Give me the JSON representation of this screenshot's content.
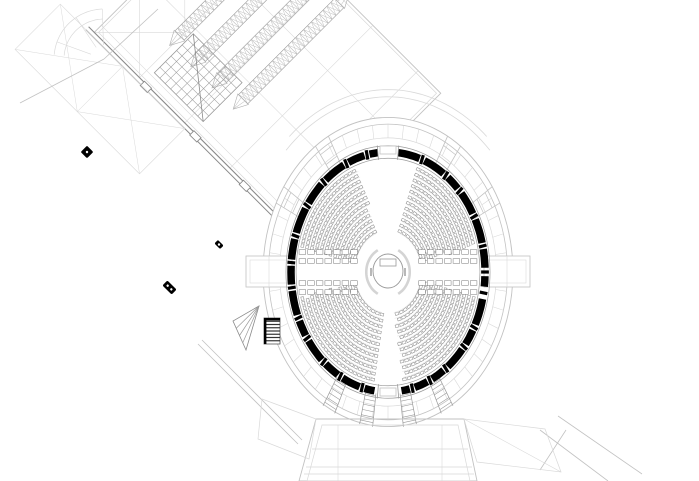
{
  "meta": {
    "drawing_type": "architectural-floor-plan",
    "subject": "elliptical auditorium with two angled wings",
    "canvas": {
      "width": 699,
      "height": 481
    }
  },
  "colors": {
    "background": "#ffffff",
    "faint": "#d9d9d9",
    "light": "#c2c2c2",
    "mid": "#9a9a9a",
    "dark": "#666666",
    "black": "#000000",
    "seat": "#8f8f8f",
    "guide": "#e3e3e3"
  },
  "auditorium": {
    "center": {
      "x": 388,
      "y": 272
    },
    "base": {
      "rx": 97,
      "ry": 120
    },
    "outer_rings": [
      {
        "f": 1.288,
        "stroke": "light",
        "w": 0.9
      },
      {
        "f": 1.232,
        "stroke": "light",
        "w": 0.8
      },
      {
        "f": 1.118,
        "stroke": "faint",
        "w": 0.7
      }
    ],
    "shoulder_arcs": [
      {
        "f": 1.52,
        "a0": -132,
        "a1": -48
      },
      {
        "f": 1.46,
        "a0": -136,
        "a1": -44
      }
    ],
    "tick": {
      "step": 7.5,
      "f0": 1.118,
      "f1": 1.232
    },
    "wall": {
      "thickness": 7.5,
      "face_in_f": 0.948,
      "face_out_f": 1.052,
      "segments": [
        [
          -84,
          -71
        ],
        [
          -68,
          -55
        ],
        [
          -52,
          -44
        ],
        [
          -41,
          -29
        ],
        [
          -26,
          -14
        ],
        [
          -11,
          -2
        ],
        [
          2,
          7
        ],
        [
          13,
          26
        ],
        [
          29,
          37
        ],
        [
          40,
          52
        ],
        [
          55,
          63
        ],
        [
          66,
          74
        ],
        [
          77,
          82
        ],
        [
          98,
          104
        ],
        [
          107,
          118
        ],
        [
          121,
          130
        ],
        [
          133,
          145
        ],
        [
          148,
          156
        ],
        [
          159,
          171
        ],
        [
          174,
          183
        ],
        [
          186,
          196
        ],
        [
          199,
          212
        ],
        [
          215,
          227
        ],
        [
          230,
          243
        ],
        [
          246,
          256
        ],
        [
          259,
          264
        ]
      ],
      "tick_f0": 0.96,
      "tick_f1": 1.04,
      "door_angles": [
        -90,
        90
      ],
      "door_jamb_offset": 6,
      "door_rects": [
        {
          "x": 380,
          "y": 146,
          "w": 16,
          "h": 8
        },
        {
          "x": 380,
          "y": 388,
          "w": 16,
          "h": 8
        }
      ]
    },
    "spokes_wedge": {
      "angles": [
        -150,
        -122,
        -58,
        -30
      ],
      "half_deg": 3.5,
      "f0": 1.0,
      "f1": 1.29,
      "cross_f": [
        1.1,
        1.2
      ]
    },
    "spokes_stair": {
      "angles": [
        62,
        80,
        100,
        118
      ],
      "half_deg": 3,
      "f0": 1.02,
      "f1": 1.3,
      "rung_step_f": 0.045
    },
    "connectors": [
      {
        "x": 246,
        "y": 256,
        "w": 46,
        "h": 31
      },
      {
        "x": 484,
        "y": 256,
        "w": 46,
        "h": 31
      }
    ],
    "seating": {
      "rows": 12,
      "f_inner": 0.36,
      "f_step": 0.05,
      "seat": {
        "w": 3.5,
        "h": 2.6,
        "spacing": 4.7
      },
      "sectors": [
        [
          -70,
          -14
        ],
        [
          14,
          80
        ],
        [
          100,
          166
        ],
        [
          194,
          250
        ]
      ],
      "guide_inset": 0.018
    },
    "desks": {
      "dy": [
        -20,
        -11,
        11,
        20
      ],
      "x0": 34,
      "x1": 94,
      "pitch": 8.6,
      "w": 6.6,
      "h": 4.6
    },
    "podium": {
      "rx": 15,
      "ry": 17,
      "rect": {
        "x": 380,
        "y": 259,
        "w": 16,
        "h": 7
      },
      "ring_f": 1.45,
      "ring_arcs": [
        [
          -62,
          62
        ],
        [
          118,
          242
        ]
      ]
    }
  },
  "left_wing": {
    "pivot": {
      "x": 8,
      "y": 130
    },
    "angle": 45,
    "rect": {
      "x": 0,
      "y": -202,
      "w": 288,
      "h": 202
    },
    "inset": 3,
    "grid_step": 64,
    "x_panels": [
      [
        0,
        -64
      ],
      [
        0,
        -128
      ],
      [
        0,
        -192
      ]
    ],
    "truss": {
      "band_x": [
        56,
        86,
        116,
        146
      ],
      "w": 13,
      "y0": -194,
      "y1": -58,
      "cell": 5.5,
      "apex": 14
    },
    "skylight": {
      "x": 71,
      "y": -69,
      "w": 69,
      "h": 55,
      "cols": 9,
      "rows": 7
    },
    "wall": {
      "y": 0,
      "offset": 4,
      "jogs": [
        70,
        140,
        210
      ]
    },
    "annex": {
      "x": -44,
      "y": 4,
      "w": 176,
      "h": 64
    }
  },
  "right_wing": {
    "pivot": {
      "x": 527,
      "y": 87
    },
    "angle": 45,
    "rect": {
      "x": 0,
      "y": 0,
      "w": 240,
      "h": 190
    },
    "inset": 3,
    "grid_step": 64,
    "x_panels": [
      [
        128,
        0
      ],
      [
        192,
        0
      ],
      [
        0,
        64
      ]
    ],
    "strip": {
      "x": 6,
      "y": -42,
      "w": 250,
      "h": 30,
      "brace_step": 62
    },
    "wall_x": 236
  },
  "stage": {
    "outer": [
      [
        316,
        419
      ],
      [
        464,
        419
      ],
      [
        477,
        481
      ],
      [
        299,
        481
      ]
    ],
    "inner": [
      [
        322,
        425
      ],
      [
        458,
        425
      ],
      [
        470,
        481
      ],
      [
        307,
        481
      ]
    ],
    "h_lines": [
      [
        312,
        449,
        468,
        449
      ],
      [
        306,
        467,
        472,
        467
      ],
      [
        304,
        474,
        474,
        474
      ]
    ],
    "v_lines": [
      [
        338,
        425,
        338,
        481
      ],
      [
        442,
        425,
        442,
        481
      ]
    ],
    "left_flap": [
      [
        262,
        399
      ],
      [
        316,
        419
      ],
      [
        309,
        459
      ],
      [
        258,
        439
      ]
    ],
    "right_flap": [
      [
        464,
        419
      ],
      [
        545,
        429
      ],
      [
        561,
        472
      ],
      [
        477,
        462
      ]
    ]
  },
  "stairs": {
    "fan": {
      "apex": [
        259,
        306
      ],
      "b": [
        233,
        321
      ],
      "c": [
        246,
        350
      ],
      "steps": 3
    },
    "dark": {
      "x": 264,
      "y": 318,
      "w": 16,
      "h": 26,
      "treads": 7
    }
  },
  "furniture": [
    {
      "cx": 169.5,
      "cy": 287.5,
      "w": 13,
      "h": 7,
      "angle": 45,
      "dots": 2
    },
    {
      "cx": 219,
      "cy": 244.5,
      "w": 8,
      "h": 5,
      "angle": 45,
      "dots": 1
    },
    {
      "cx": 87,
      "cy": 152,
      "w": 9,
      "h": 9,
      "angle": 45,
      "dots": 1
    }
  ],
  "arc_fan": {
    "cx": 104,
    "cy": 59,
    "r": [
      40,
      50
    ],
    "a0": 185,
    "a1": 268,
    "radials": [
      200,
      236,
      268
    ],
    "r_in": 14
  },
  "misc_lines": [
    [
      198,
      344,
      298,
      444
    ],
    [
      202,
      340,
      302,
      440
    ],
    [
      20,
      103,
      104,
      59
    ],
    [
      104,
      59,
      158,
      9
    ],
    [
      540,
      430,
      608,
      481
    ],
    [
      558,
      416,
      642,
      474
    ],
    [
      566,
      430,
      540,
      470
    ]
  ]
}
